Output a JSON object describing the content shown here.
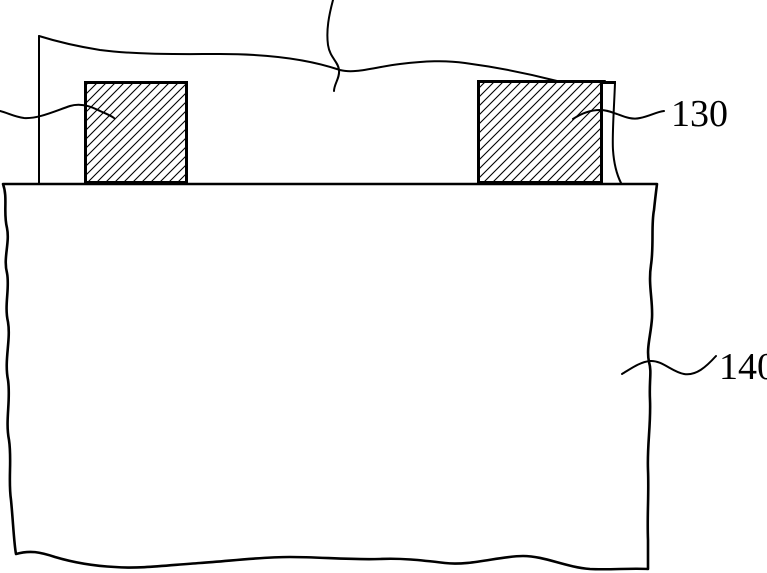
{
  "diagram": {
    "type": "patent-cross-section-figure",
    "background": "#ffffff",
    "ink": "#000000",
    "labels": {
      "callout_130": "130",
      "callout_140": "140"
    }
  }
}
